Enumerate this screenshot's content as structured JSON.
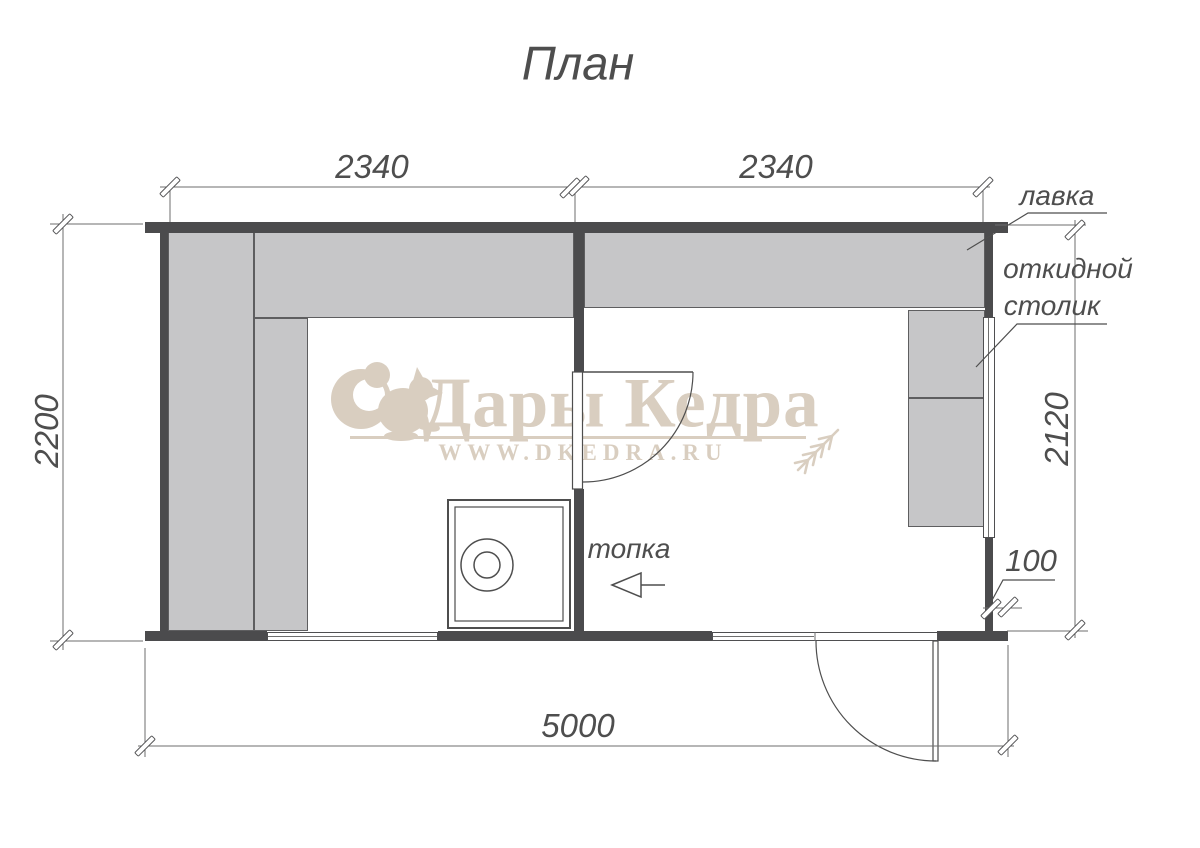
{
  "page": {
    "title": "План"
  },
  "watermark": {
    "brand": "Дары Кедра",
    "website": "WWW.DKEDRA.RU"
  },
  "dimensions": {
    "top_left_width": "2340",
    "top_right_width": "2340",
    "left_height": "2200",
    "right_bench_length": "2120",
    "right_offset": "100",
    "total_width": "5000"
  },
  "labels": {
    "bench": "лавка",
    "folding_table_line1": "откидной",
    "folding_table_line2": "столик",
    "firebox": "топка"
  },
  "colors": {
    "wall": "#4b4b4d",
    "bench": "#c6c6c8",
    "line": "#6e6e6e",
    "ink": "#4e4e4e",
    "wm": "#d9cec0"
  }
}
